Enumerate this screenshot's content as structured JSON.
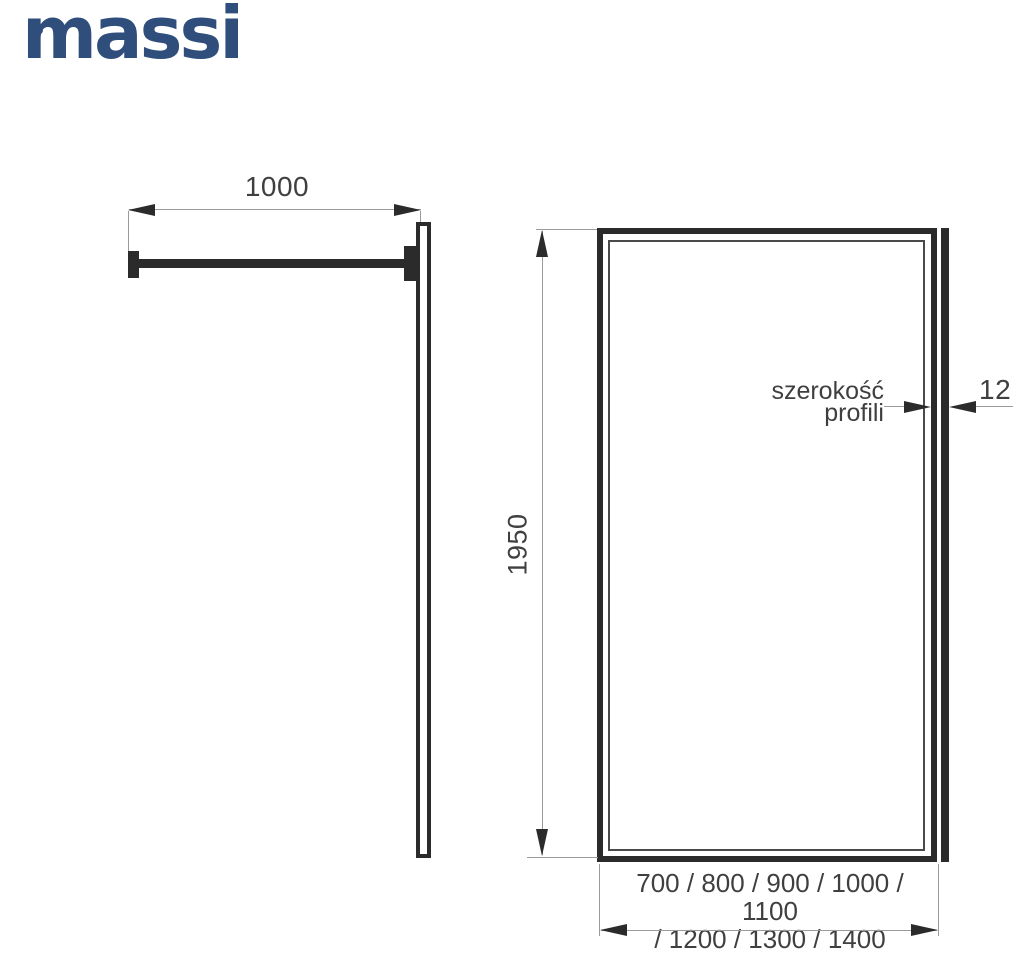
{
  "logo": {
    "text": "massi"
  },
  "side_view": {
    "width_dim": "1000"
  },
  "front_view": {
    "height_dim": "1950",
    "profile_label": {
      "line1": "szerokość",
      "line2": "profili"
    },
    "profile_width_dim": "12",
    "available_widths": {
      "line1": "700 / 800 / 900 / 1000 / 1100",
      "line2": "/ 1200 / 1300 / 1400"
    }
  },
  "colors": {
    "logo_blue": "#2f4e7c",
    "ink": "#2b2b2b",
    "dim": "#9b9b9b",
    "label": "#3f3f3f",
    "inner_frame": "#4a4a4a"
  }
}
